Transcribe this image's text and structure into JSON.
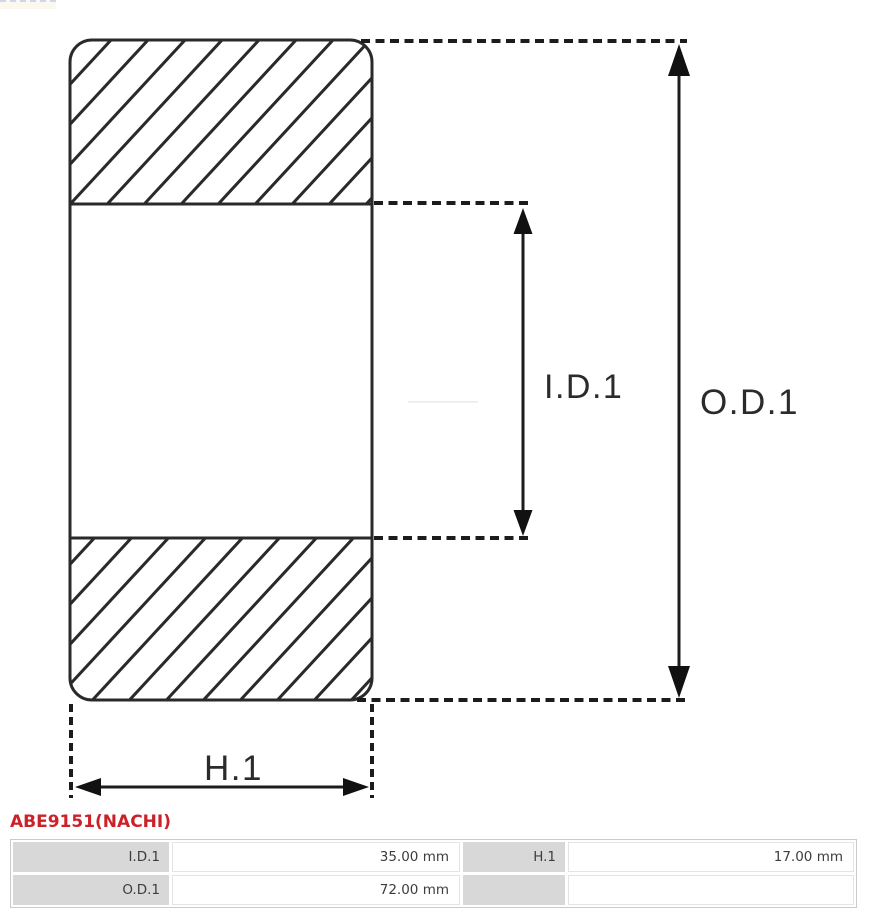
{
  "title": "ABE9151(NACHI)",
  "colors": {
    "title_red": "#cc2128",
    "line_dark": "#2a2a2a",
    "table_label_bg": "#d8d8d8"
  },
  "diagram": {
    "id1_label": "I.D.1",
    "od1_label": "O.D.1",
    "h1_label": "H.1"
  },
  "table": {
    "rows": [
      {
        "c1_label": "I.D.1",
        "c1_value": "35.00 mm",
        "c2_label": "H.1",
        "c2_value": "17.00 mm"
      },
      {
        "c1_label": "O.D.1",
        "c1_value": "72.00 mm",
        "c2_label": "",
        "c2_value": ""
      }
    ]
  }
}
